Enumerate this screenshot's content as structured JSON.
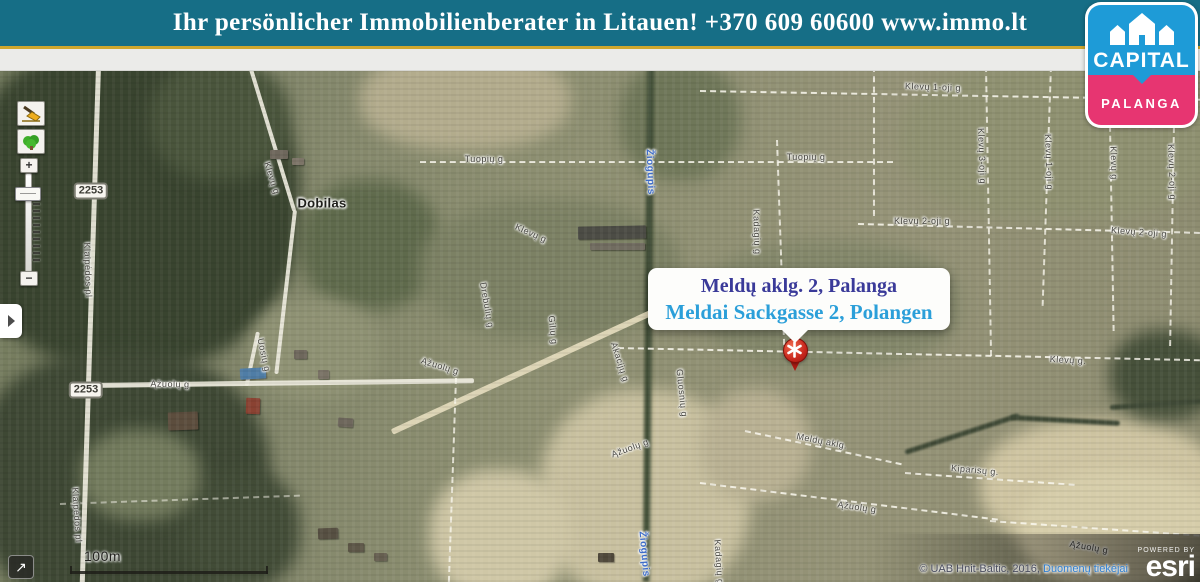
{
  "header": {
    "title": "Ihr persönlicher Immobilienberater in Litauen! +370 609 60600 www.immo.lt"
  },
  "logo": {
    "brand": "CAPITAL",
    "city": "PALANGA",
    "brand_color": "#1e9bd7",
    "city_color": "#e73571"
  },
  "popup": {
    "line1": "Meldų aklg. 2, Palanga",
    "line2": "Meldai Sackgasse 2, Polangen",
    "line1_color": "#3a3a99",
    "line2_color": "#2b9fd9"
  },
  "marker": {
    "color": "#c8271d",
    "symbol": "asterisk"
  },
  "controls": {
    "zoom_in": "+",
    "zoom_out": "−",
    "fullscreen_arrow": "↗"
  },
  "scalebar": {
    "label": "100m"
  },
  "attribution": {
    "copyright": "© UAB Hnit-Baltic, 2016,",
    "providers_link": "Duomenų tiekėjai",
    "powered_by": "POWERED BY",
    "esri_logo": "esri"
  },
  "map": {
    "badges": [
      {
        "text": "2253",
        "x": 91,
        "y": 191
      },
      {
        "text": "2253",
        "x": 86,
        "y": 390
      }
    ],
    "labels": [
      {
        "text": "Klaipėdos pl",
        "x": 88,
        "y": 270,
        "rot": 88
      },
      {
        "text": "Klaipėdos pl",
        "x": 77,
        "y": 515,
        "rot": 86
      },
      {
        "text": "Klevų g",
        "x": 272,
        "y": 178,
        "rot": 72
      },
      {
        "text": "Dobilas",
        "x": 322,
        "y": 203,
        "rot": 0,
        "type": "settlement"
      },
      {
        "text": "Tuopių g",
        "x": 484,
        "y": 159,
        "rot": 0
      },
      {
        "text": "Tuopių g",
        "x": 806,
        "y": 157,
        "rot": 0
      },
      {
        "text": "Žiogupis",
        "x": 650,
        "y": 172,
        "rot": 88,
        "type": "water"
      },
      {
        "text": "Žiogupis",
        "x": 644,
        "y": 554,
        "rot": 85,
        "type": "water"
      },
      {
        "text": "Klevų g",
        "x": 531,
        "y": 233,
        "rot": 24
      },
      {
        "text": "Klevų 1-oji g",
        "x": 933,
        "y": 87,
        "rot": 2
      },
      {
        "text": "Klevų 3-oji g",
        "x": 982,
        "y": 156,
        "rot": 88
      },
      {
        "text": "Klevų 1-oji g",
        "x": 1049,
        "y": 162,
        "rot": 88
      },
      {
        "text": "Klevų g",
        "x": 1114,
        "y": 163,
        "rot": 88
      },
      {
        "text": "Klevų 2-oji g",
        "x": 1172,
        "y": 172,
        "rot": 88
      },
      {
        "text": "Klevų 2-oji g",
        "x": 922,
        "y": 221,
        "rot": 0
      },
      {
        "text": "Klevų 2-oji g",
        "x": 1139,
        "y": 232,
        "rot": 4
      },
      {
        "text": "Kadagių g",
        "x": 757,
        "y": 232,
        "rot": 88
      },
      {
        "text": "Ąžuolų g",
        "x": 170,
        "y": 384,
        "rot": 1
      },
      {
        "text": "Uosių g",
        "x": 264,
        "y": 355,
        "rot": 78
      },
      {
        "text": "Ąžuolų g",
        "x": 440,
        "y": 366,
        "rot": 17
      },
      {
        "text": "Drebulių g",
        "x": 487,
        "y": 305,
        "rot": 80
      },
      {
        "text": "Gilių g",
        "x": 553,
        "y": 330,
        "rot": 84
      },
      {
        "text": "Akacijų g",
        "x": 620,
        "y": 362,
        "rot": 72
      },
      {
        "text": "Gluosnių g",
        "x": 682,
        "y": 393,
        "rot": 84
      },
      {
        "text": "Ąžuolų g",
        "x": 630,
        "y": 448,
        "rot": -20
      },
      {
        "text": "Meldų aklg.",
        "x": 822,
        "y": 441,
        "rot": 11
      },
      {
        "text": "Klevų g.",
        "x": 1068,
        "y": 360,
        "rot": 3
      },
      {
        "text": "Kiparisų g.",
        "x": 975,
        "y": 470,
        "rot": 5
      },
      {
        "text": "Ąžuolų g",
        "x": 857,
        "y": 507,
        "rot": 8
      },
      {
        "text": "Kadagių g",
        "x": 719,
        "y": 562,
        "rot": 86
      },
      {
        "text": "Ąžuolų g",
        "x": 1089,
        "y": 547,
        "rot": 10
      }
    ]
  }
}
